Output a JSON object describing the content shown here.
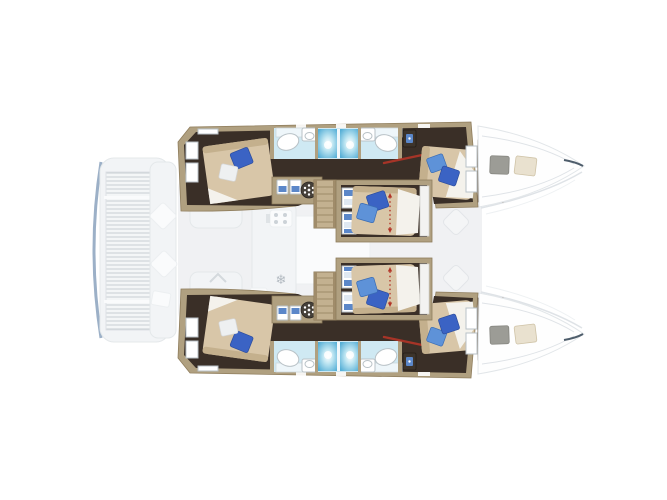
{
  "canvas": {
    "width": 667,
    "height": 500,
    "background": "#ffffff"
  },
  "colors": {
    "background": "#ffffff",
    "faded_fill": "#edeff1",
    "faded_white": "#fafbfc",
    "faded_outline": "#dfe3e7",
    "faded_blue_edge": "#8ba2bd",
    "hull_wall": "#b0a080",
    "hull_wall_dark": "#8f7d5c",
    "floor_dark": "#3a2f27",
    "mattress": "#d8c6a8",
    "mattress_shade": "#c4b08d",
    "sheet_white": "#f4f2ec",
    "pillow_blue": "#3b63c4",
    "pillow_blue_light": "#5e92d8",
    "pillow_white": "#eef0f1",
    "bath_floor": "#cfe9f3",
    "shower_blue": "#54aed6",
    "shower_blue_light": "#bfe6f2",
    "fixture_stroke": "#b9c2c7",
    "wardrobe_brown": "#8b7254",
    "hatch_gray": "#9c9c96",
    "hatch_tan": "#e9e1cf",
    "accent_red": "#b23528",
    "stairs": "#c3b190",
    "cubby_blue": "#5b87c9"
  },
  "icons": {
    "snowflake": "❄"
  },
  "plan": {
    "type": "floorplan",
    "subject": "catamaran lower-deck cabin layout, bow pointing right",
    "visible_counts": {
      "hulls": 2,
      "cabins": 6,
      "double_beds": 6,
      "blue_pillows": 10,
      "white_pillows": 2,
      "wet_rooms": 4,
      "showers": 4,
      "sinks": 4,
      "toilets": 4,
      "staircases": 2,
      "wardrobes": 2,
      "bow_deck_hatches": 4,
      "red_dimension_markers": 2
    },
    "faded_upper_deck_elements": [
      "swim-platform-grating",
      "transom-steps",
      "cockpit-cushions",
      "saloon-slab",
      "saloon-table",
      "galley-stove",
      "galley-fridge-snowflake",
      "companionway-chevron"
    ]
  }
}
